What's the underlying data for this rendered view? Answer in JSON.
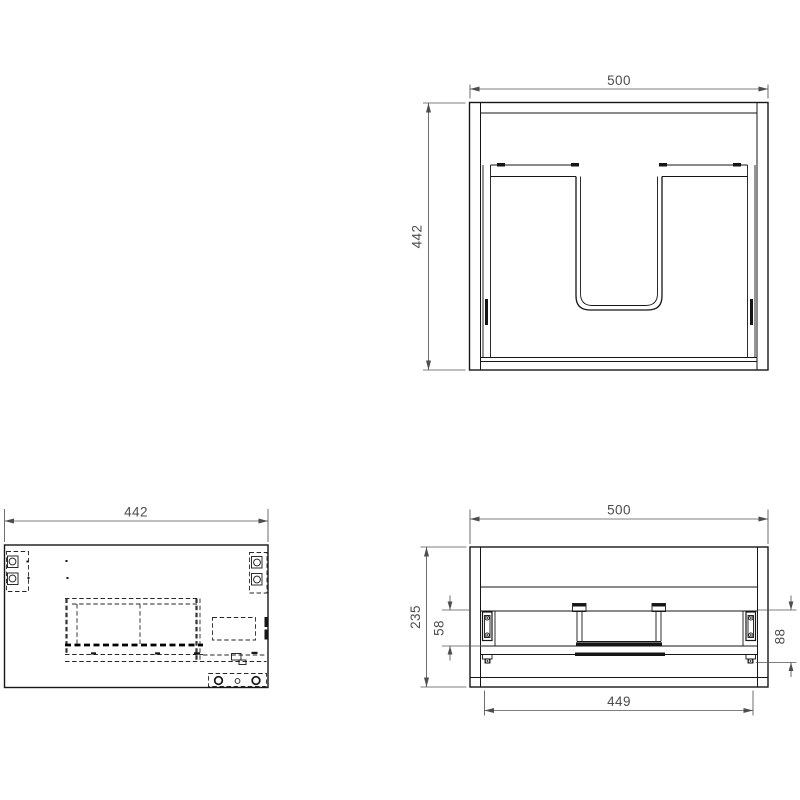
{
  "views": {
    "plan": {
      "dim_width": "500",
      "dim_depth": "442"
    },
    "side": {
      "dim_width": "442"
    },
    "rear": {
      "dim_width": "500",
      "dim_height": "235",
      "dim_slide": "58",
      "dim_offset": "88",
      "dim_inner_width": "449"
    }
  },
  "colors": {
    "background": "#ffffff",
    "body_line": "#161616",
    "dimension_line": "#555555",
    "dimension_text": "#4d4d4d"
  }
}
